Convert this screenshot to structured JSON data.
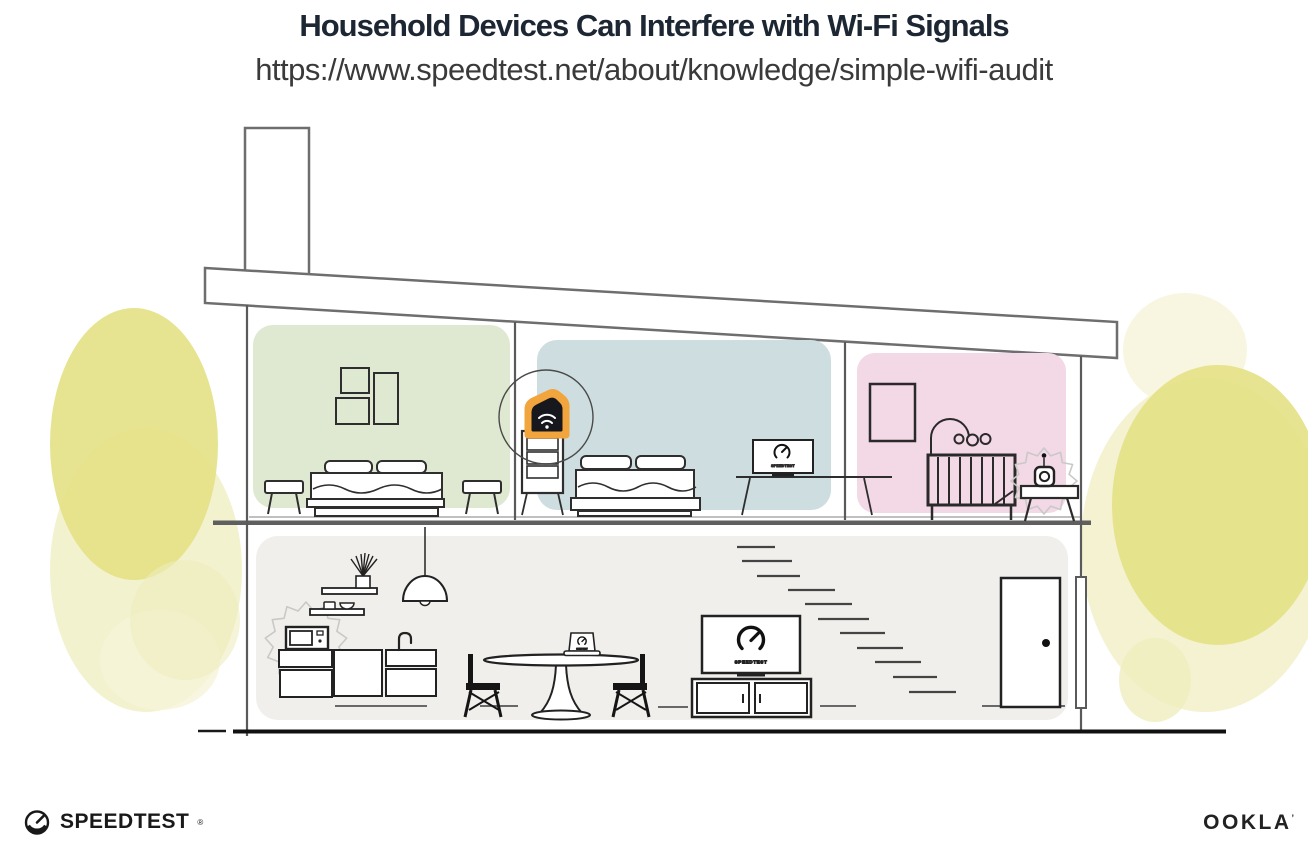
{
  "header": {
    "title": "Household Devices Can Interfere with Wi-Fi Signals",
    "url": "https://www.speedtest.net/about/knowledge/simple-wifi-audit"
  },
  "branding": {
    "speedtest_label": "SPEEDTEST",
    "speedtest_trademark": "®",
    "ookla_label": "OOKLA",
    "ookla_trademark": "’"
  },
  "illustration": {
    "bedroom_tv_label": "SPEEDTEST",
    "living_tv_label": "SPEEDTEST",
    "laptop_label": "SPEEDTEST"
  },
  "colors": {
    "title_navy": "#1d2633",
    "url_gray": "#3a3a3a",
    "room_green": "#dfe9d1",
    "room_blue": "#cedde0",
    "room_pink": "#f3d8e6",
    "ground": "#f1efec",
    "foliage_dark": "#e4e185",
    "foliage_light": "#efedbe",
    "foliage_pale": "#f6f4d8",
    "glow_orange": "#f2a43d",
    "router_black": "#16181d",
    "burst_gray": "#c9c9c7"
  }
}
